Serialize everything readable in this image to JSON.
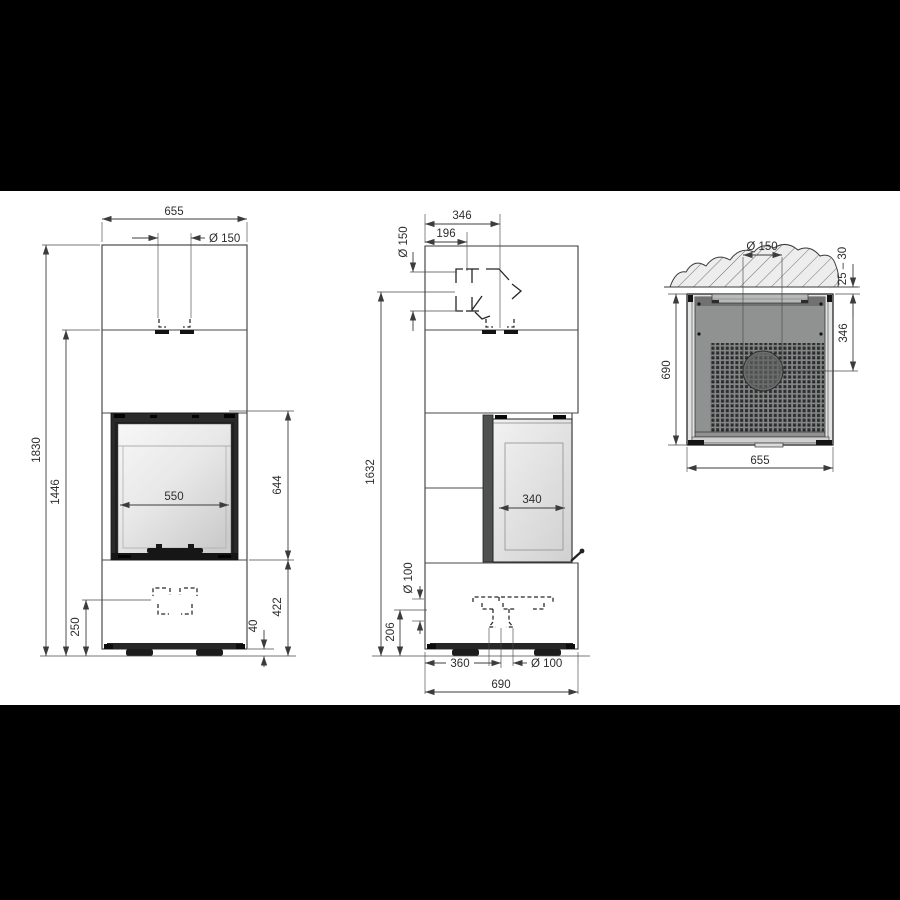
{
  "page": {
    "background": "#000000",
    "canvas": "#ffffff",
    "line_color": "#3c3c3c",
    "body_fill": "#eaeaea",
    "steel_plate_fill": "#909292",
    "firebox_fill": "#2a2a2a"
  },
  "front_view": {
    "width": "655",
    "flue_diameter": "Ø 150",
    "total_height": "1830",
    "upper_section_height": "1446",
    "air_inlet_height": "250",
    "glass_width": "550",
    "firebox_height": "644",
    "base_height": "422",
    "plinth_height": "40"
  },
  "side_view": {
    "flue_depth": "346",
    "flue_offset": "196",
    "flue_diameter": "Ø 150",
    "rear_outlet_height": "1632",
    "glass_depth": "340",
    "air_inlet_diameter": "Ø 100",
    "air_inlet_height": "206",
    "air_inlet_offset": "360",
    "air_inlet_diameter_bottom": "Ø 100",
    "total_depth": "690"
  },
  "top_view": {
    "flue_diameter": "Ø 150",
    "wall_clearance": "25 – 30",
    "depth": "690",
    "flue_center_offset": "346",
    "width": "655"
  }
}
